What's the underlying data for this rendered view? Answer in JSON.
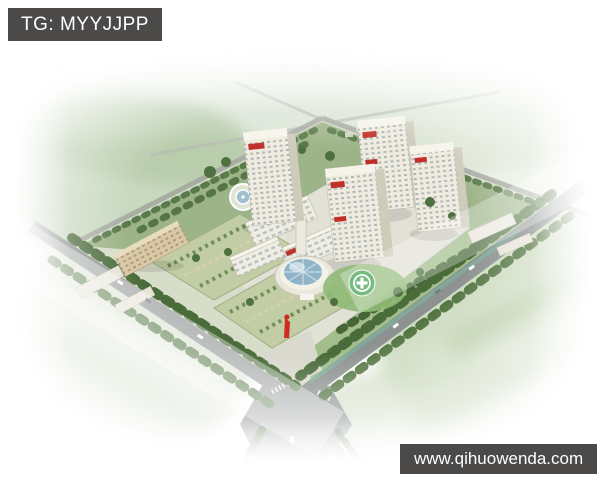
{
  "window": {
    "width": 600,
    "height": 480
  },
  "overlays": {
    "tag": {
      "text": "TG: MYYJJPP"
    },
    "watermark": {
      "text": "www.qihuowenda.com"
    }
  },
  "palette": {
    "overlay_bg": "#4c4a48",
    "overlay_text": "#ffffff",
    "road_gray": "#8d9190",
    "minor_road_gray": "#a8ada4",
    "tree_green": "#4a6b3a",
    "lawn_green": "#93ad7c",
    "field_green": "#b7c9a5",
    "building_cream": "#efecdf",
    "building_shade": "#cfccbc",
    "glass_blue": "#8fb3c8",
    "sign_red": "#c03028",
    "sculpture_red": "#cf2b1f",
    "helipad_green": "#3d9e4a",
    "canal_teal": "#7fae9e"
  },
  "scene": {
    "type": "aerial-architectural-rendering",
    "features": [
      "hospital campus with high-rise ward towers bearing red signage",
      "round glass-domed outpatient hall",
      "green helipad with white cross",
      "geometric gardens and parking courts with red landmark sculpture",
      "circular fountain plaza",
      "tree-lined perimeter roads meeting at a wide junction",
      "hazy farmland horizon with distant crossroads",
      "white vignette fading at image edges"
    ]
  }
}
